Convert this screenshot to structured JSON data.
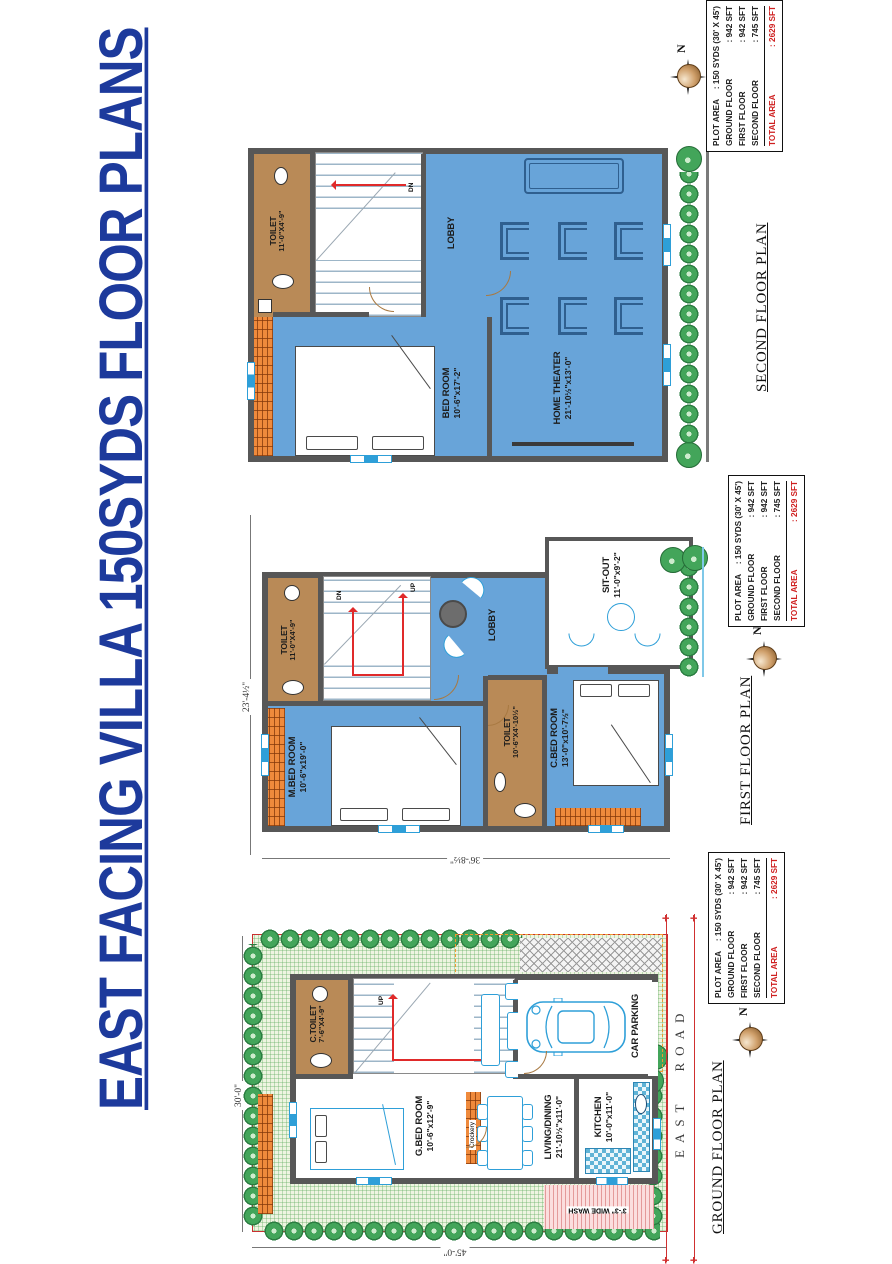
{
  "title": "EAST FACING VILLA 150SYDS FLOOR PLANS",
  "colors": {
    "title_blue": "#1d3a9c",
    "room_blue": "#68a4d9",
    "wall_gray": "#575757",
    "toilet_brown": "#b98a57",
    "brick_orange": "#ef8a3c",
    "tree_green": "#43a55a",
    "boundary_red": "#c93030",
    "furniture_cyan": "#2e9fd8",
    "total_red": "#cf2020"
  },
  "info_table": {
    "rows": [
      {
        "label": "PLOT AREA",
        "value": ": 150 SYDS (30' X 45')"
      },
      {
        "label": "GROUND FLOOR",
        "value": ": 942 SFT"
      },
      {
        "label": "FIRST FLOOR",
        "value": ": 942 SFT"
      },
      {
        "label": "SECOND FLOOR",
        "value": ": 745 SFT"
      },
      {
        "label": "TOTAL AREA",
        "value": ": 2629 SFT"
      }
    ]
  },
  "compass": {
    "north": "N"
  },
  "ground": {
    "name": "GROUND FLOOR PLAN",
    "road": "EAST ROAD",
    "dims": {
      "width": "30'-0\"",
      "depth": "45'-0\""
    },
    "stair_up": "UP",
    "rooms": {
      "c_toilet": {
        "name": "C.TOILET",
        "size": "7'-6\"X4'-9\""
      },
      "g_bed": {
        "name": "G.BED ROOM",
        "size": "10'-6\"x12'-9\""
      },
      "living": {
        "name": "LIVING/DINING",
        "size": "21'-10½\"x11'-0\""
      },
      "kitchen": {
        "name": "KITCHEN",
        "size": "10'-0\"x11'-0\""
      },
      "parking": {
        "name": "CAR PARKING"
      },
      "crockery": {
        "name": "Crockery"
      },
      "wash": {
        "name": "3'-3\" WIDE WASH"
      }
    }
  },
  "first": {
    "name": "FIRST FLOOR PLAN",
    "dims": {
      "width": "23'-4½\"",
      "depth": "36'-8½\""
    },
    "stair_up": "UP",
    "stair_dn": "DN",
    "rooms": {
      "toilet_top": {
        "name": "TOILET",
        "size": "11'-0\"X4'-9\""
      },
      "m_bed": {
        "name": "M.BED ROOM",
        "size": "10'-6\"x19'-0\""
      },
      "toilet_mid": {
        "name": "TOILET",
        "size": "10'-6\"X4'-10½\""
      },
      "c_bed": {
        "name": "C.BED ROOM",
        "size": "13'-0\"x10'-7½\""
      },
      "lobby": {
        "name": "LOBBY"
      },
      "sitout": {
        "name": "SIT-OUT",
        "size": "11'-0\"x9'-2\""
      }
    }
  },
  "second": {
    "name": "SECOND FLOOR PLAN",
    "stair_dn": "DN",
    "rooms": {
      "toilet": {
        "name": "TOILET",
        "size": "11'-0\"X4'-9\""
      },
      "bed": {
        "name": "BED ROOM",
        "size": "10'-6\"x17'-2\""
      },
      "lobby": {
        "name": "LOBBY"
      },
      "theater": {
        "name": "HOME THEATER",
        "size": "21'-10½\"x13'-0\""
      }
    }
  }
}
